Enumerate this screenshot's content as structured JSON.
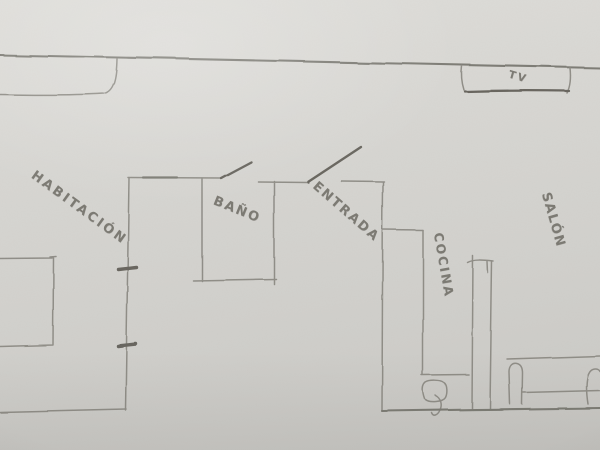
{
  "palette": {
    "paper": "#d5d4d0",
    "paper_light": "#e1e0dc",
    "paper_dark": "#c6c5c1",
    "pencil": "#8a8881",
    "pencil_strong": "#76746d",
    "pencil_dark": "#5e5c55",
    "label_text": "#7c7a73"
  },
  "floorplan": {
    "rooms": {
      "habitacion": {
        "label": "HABITACIÓN"
      },
      "bano": {
        "label": "BAÑO"
      },
      "entrada": {
        "label": "ENTRADA"
      },
      "cocina": {
        "label": "COCINA"
      },
      "salon": {
        "label": "SALÓN"
      }
    },
    "furniture": {
      "tv": {
        "label": "TV"
      }
    }
  }
}
